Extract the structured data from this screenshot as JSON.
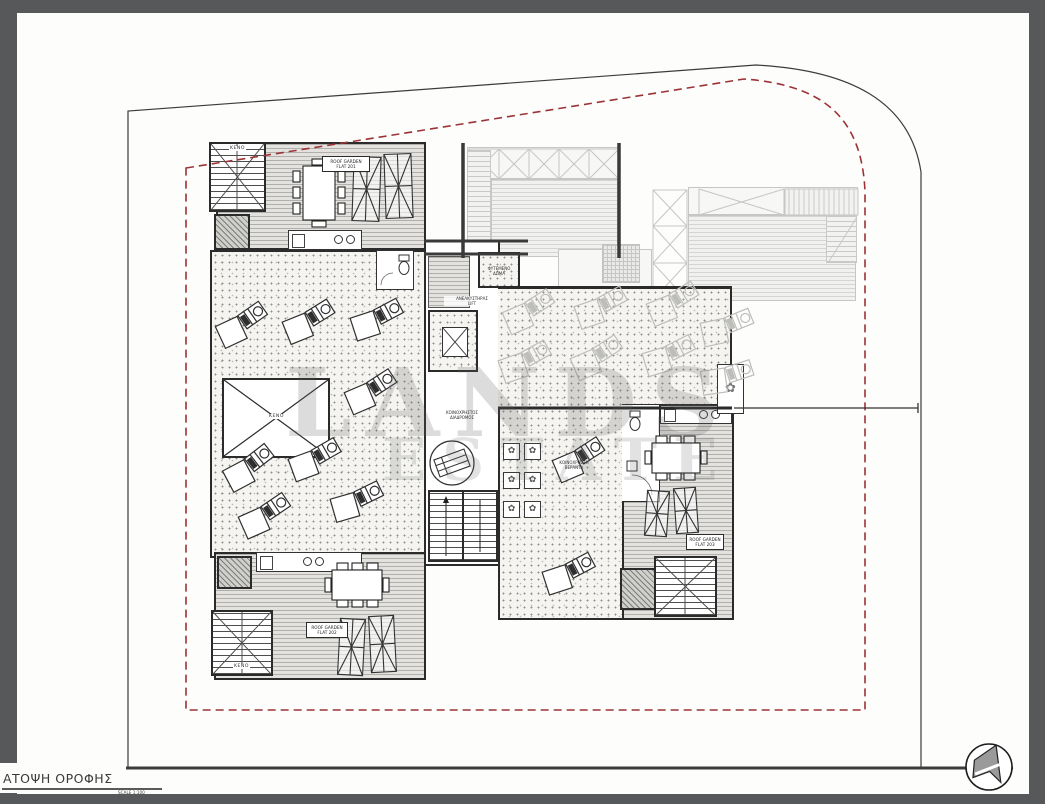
{
  "sheet": {
    "title": "ΑΤΟΨΗ ΟΡΟΦΗΣ",
    "scale": "SCALE  1:100"
  },
  "watermark": {
    "line1": "LANDS",
    "line2": "ESTATE"
  },
  "labels": {
    "flat_top_l1": "ROOF GARDEN",
    "flat_top_l2": "FLAT 201",
    "flat_bottom_l1": "ROOF GARDEN",
    "flat_bottom_l2": "FLAT 202",
    "flat_right_l1": "ROOF GARDEN",
    "flat_right_l2": "FLAT 203",
    "void": "ΚΕΝΟ",
    "lift_l1": "ΑΝΕΛΚΥΣΤΗΡΑΣ",
    "lift_l2": "LIFT",
    "corridor_l1": "ΚΟΙΝΟΧΡΗΣΤΟΣ",
    "corridor_l2": "ΔΙΑΔΡΟΜΟΣ",
    "common_l1": "ΚΟΙΝΟΧΡΗΣΤΗ",
    "common_l2": "ΒΕΡΑΝΤΑ",
    "garden_box_l1": "ΦΥΤΕΜΕΝΟ",
    "garden_box_l2": "ΔΩΜΑ"
  },
  "colors": {
    "frame_gray": "#57585a",
    "boundary_black": "#3c3c3c",
    "boundary_red": "#9c3336",
    "wall": "#2b2b2b",
    "ghost": "#c6c6c4"
  },
  "plan": {
    "plant_glyph": "✿",
    "loungers": [
      [
        213,
        303,
        -35
      ],
      [
        280,
        300,
        -32
      ],
      [
        348,
        298,
        -28
      ],
      [
        342,
        370,
        -33
      ],
      [
        220,
        446,
        -38
      ],
      [
        286,
        438,
        -30
      ],
      [
        328,
        480,
        -26
      ],
      [
        236,
        494,
        -34
      ],
      [
        550,
        438,
        -33
      ],
      [
        540,
        552,
        -28
      ]
    ],
    "ghost_loungers": [
      [
        500,
        290,
        -33
      ],
      [
        572,
        286,
        -29
      ],
      [
        644,
        282,
        -32
      ],
      [
        698,
        306,
        -22
      ],
      [
        496,
        340,
        -29
      ],
      [
        568,
        336,
        -33
      ],
      [
        640,
        334,
        -27
      ],
      [
        698,
        356,
        -18
      ]
    ],
    "parasols": [
      [
        352,
        156,
        29,
        66,
        2
      ],
      [
        384,
        153,
        29,
        66,
        -2
      ],
      [
        338,
        618,
        27,
        58,
        3
      ],
      [
        369,
        615,
        27,
        58,
        -3
      ],
      [
        645,
        490,
        24,
        47,
        4
      ],
      [
        674,
        487,
        24,
        47,
        -4
      ]
    ],
    "planters": [
      [
        503,
        443
      ],
      [
        524,
        443
      ],
      [
        503,
        472
      ],
      [
        524,
        472
      ],
      [
        503,
        501
      ],
      [
        524,
        501
      ]
    ]
  }
}
